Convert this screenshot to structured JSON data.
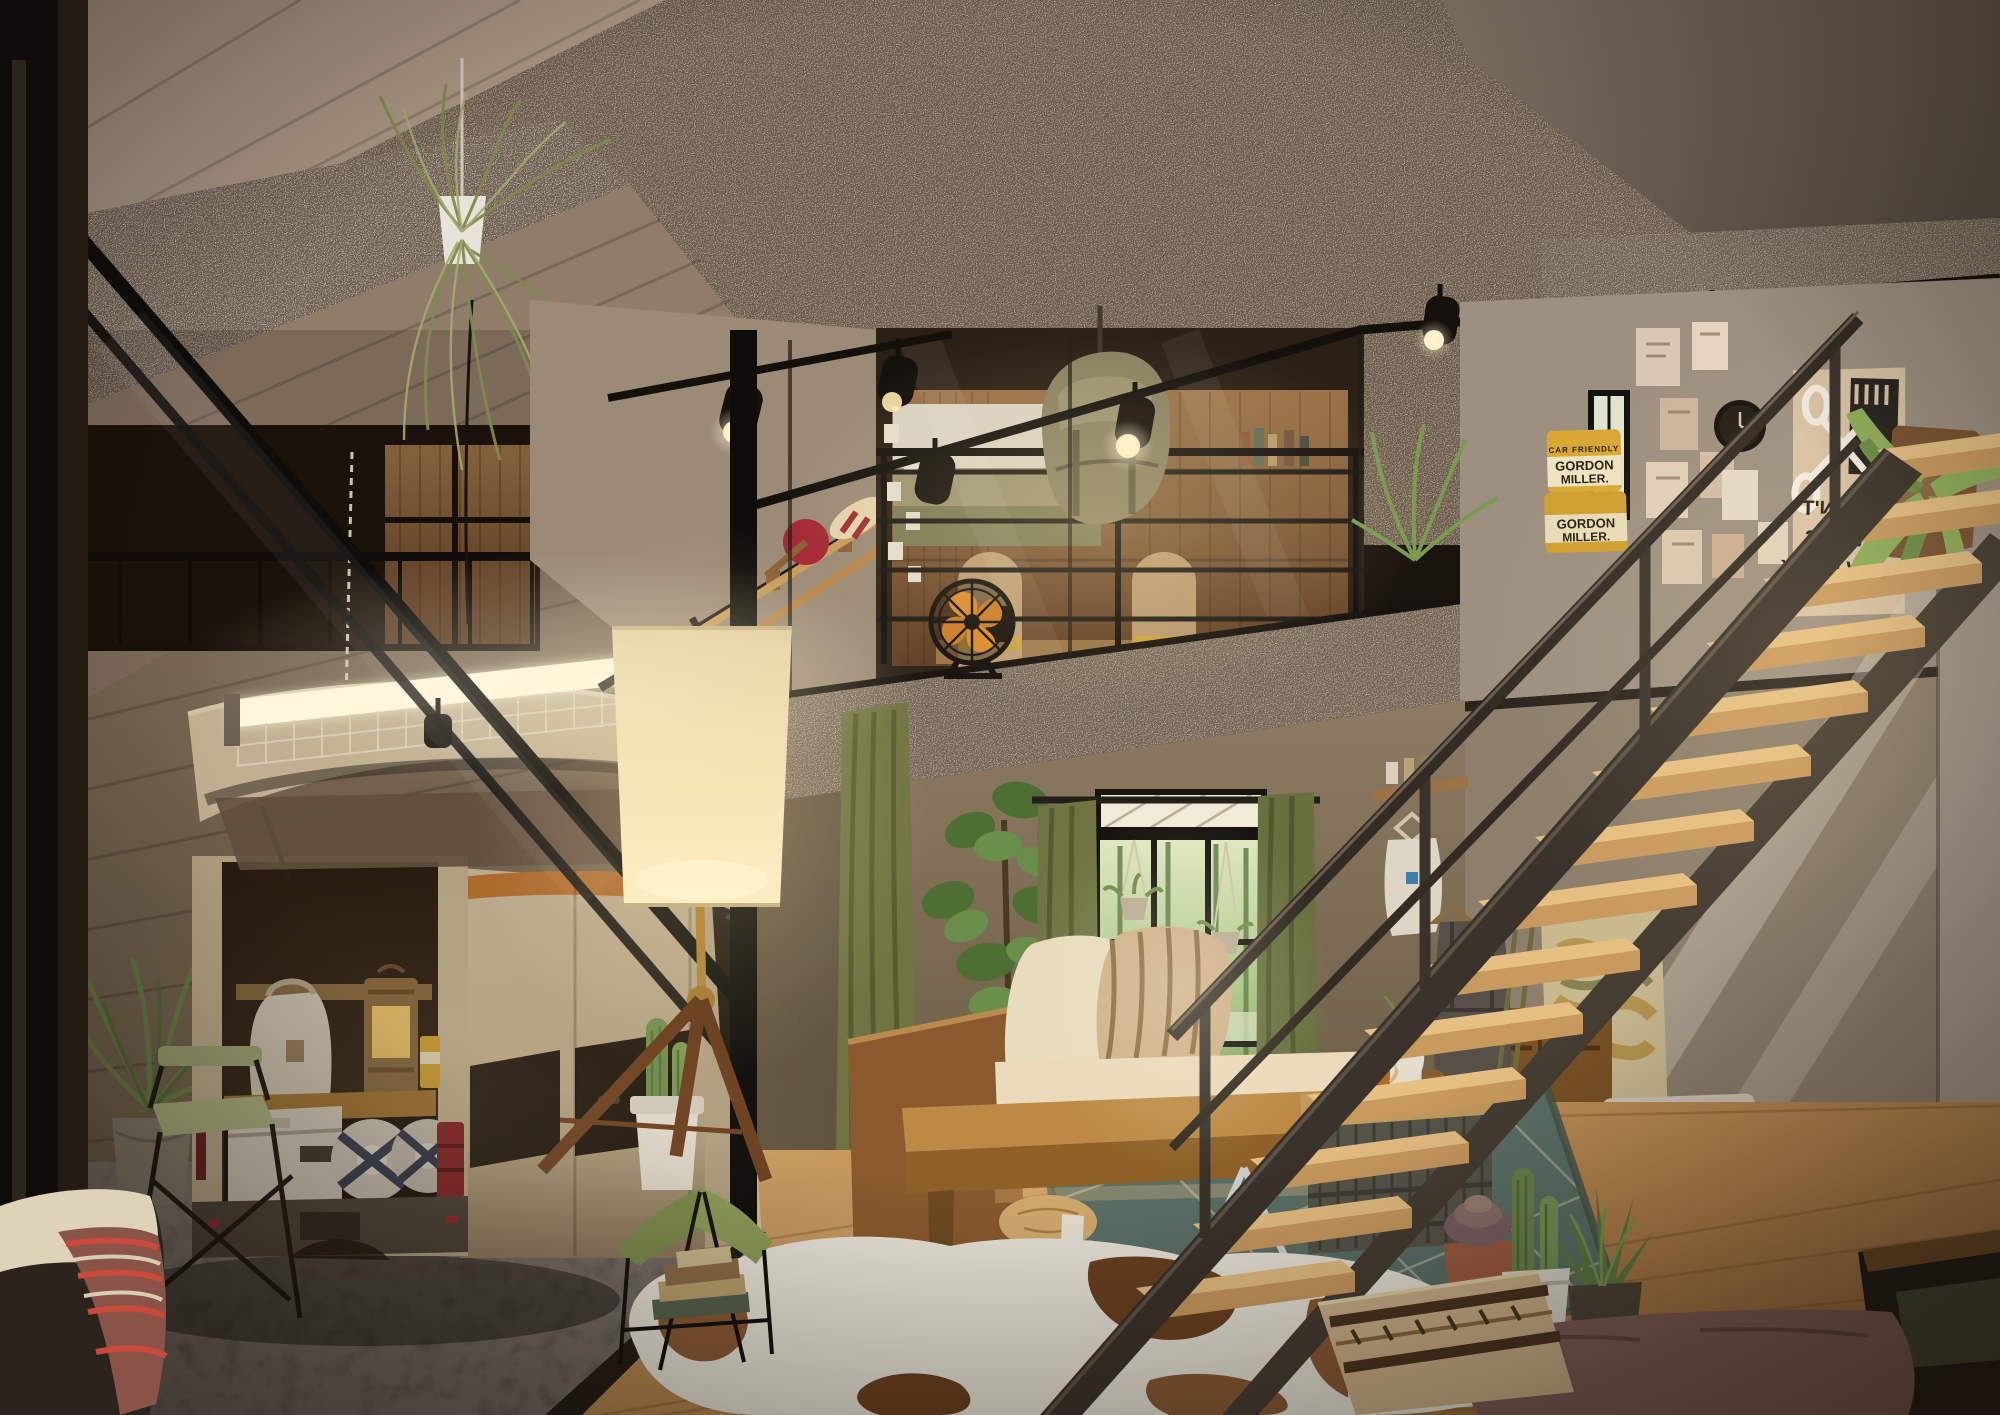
{
  "meta": {
    "title": "Camper-van loft interior - photorealistic 3D render",
    "scene_type": "interior architectural visualization",
    "lighting": "warm dusk interior lighting"
  },
  "palette": {
    "ceiling_woodwool": "#b3a391",
    "smooth_plaster": "#a69482",
    "garage_wall": "#97866f",
    "living_wall": "#857257",
    "wood_floor": "#c0945c",
    "concrete_floor": "#6e6760",
    "steel_dark": "#3a332b",
    "van_cream": "#d2c09d",
    "taillight_red": "#a3242a",
    "curtain_olive": "#6f7442",
    "foliage_green": "#6f8a4a",
    "lamp_warm": "#f6e7b8",
    "crate_olive": "#57554a",
    "fan_orange": "#d98b2e",
    "cans_yellow": "#d9a833"
  },
  "garage": {
    "van": "tan compact cargo van, tailgate open, wood board on roof",
    "cargo": [
      "canvas tote bag",
      "slatted wood lantern",
      "white camp cooler",
      "two bedrolls with navy straps",
      "yellow supply can"
    ],
    "pendant_light": "wire-cage twin-tube shop light hung on chains",
    "coat_rail": [
      "denim apron",
      "olive jacket"
    ],
    "plant": "potted palm in zinc bucket",
    "chair": "folding director's chair",
    "bench": "cushioned bench with red striped blanket"
  },
  "living_room": {
    "floor_lamp": "tripod surveyor lamp with linen drum shade",
    "sofa": "wood frame bench sofa, cream cushions, striped pillow",
    "table_bench": "wood slab bench with chrome X base",
    "stool": "plywood log stool with strap",
    "crate_table": "stacking crate coffee table, wood top",
    "crate_items": [
      "glass of tea",
      "posy vase",
      "journal",
      "wood sphere"
    ],
    "rugs": [
      "green diamond kilim",
      "brown and white cowhide"
    ],
    "window": "steel framed window to lakeside trees with two hanging planters",
    "plants": [
      "fiddle-leaf fig",
      "hanging string plant"
    ],
    "floor_pillows": [
      "kilim motif pillow",
      "mauve floor cushion"
    ],
    "cacti": [
      "columnar cactus in white pot",
      "aloe",
      "succulent in terracotta",
      "grass in square pot"
    ],
    "extras": [
      "rolled magazine",
      "book stack",
      "olive butterfly stool with cactus pot"
    ]
  },
  "mezzanine": {
    "studio": "glass-walled loft: wood shelving, landscape print, pinned photos, deer skull, two chairs",
    "backpack": "canvas rucksack hung on railing",
    "fan": "vintage orange-blade fan on ledge",
    "paddles": "red canoe paddle and striped oars on wall",
    "lights": "black track spotlights, four puck lights under edge"
  },
  "stairs": {
    "structure": "open oak treads on raw steel stringers, flat-bar railing",
    "under": [
      "walnut dresser",
      "abstract gold painting",
      "two storage boxes",
      "hanging overalls",
      "wall shelf",
      "tote bag"
    ]
  },
  "gallery_wall": {
    "clock": "round black wall clock",
    "posters": "cluster of small prints",
    "large_poster_text": "IT WON'T ALWAYS GROW BACK",
    "large_poster_lines": [
      "IT WON'T",
      "ALWAYS",
      "GROW BACK"
    ],
    "mirrored": true,
    "plant": "staghorn fern on wood mount"
  },
  "cans": {
    "label_top": "CAR FRIENDLY",
    "brand_line1": "GORDON",
    "brand_line2": "MILLER."
  }
}
